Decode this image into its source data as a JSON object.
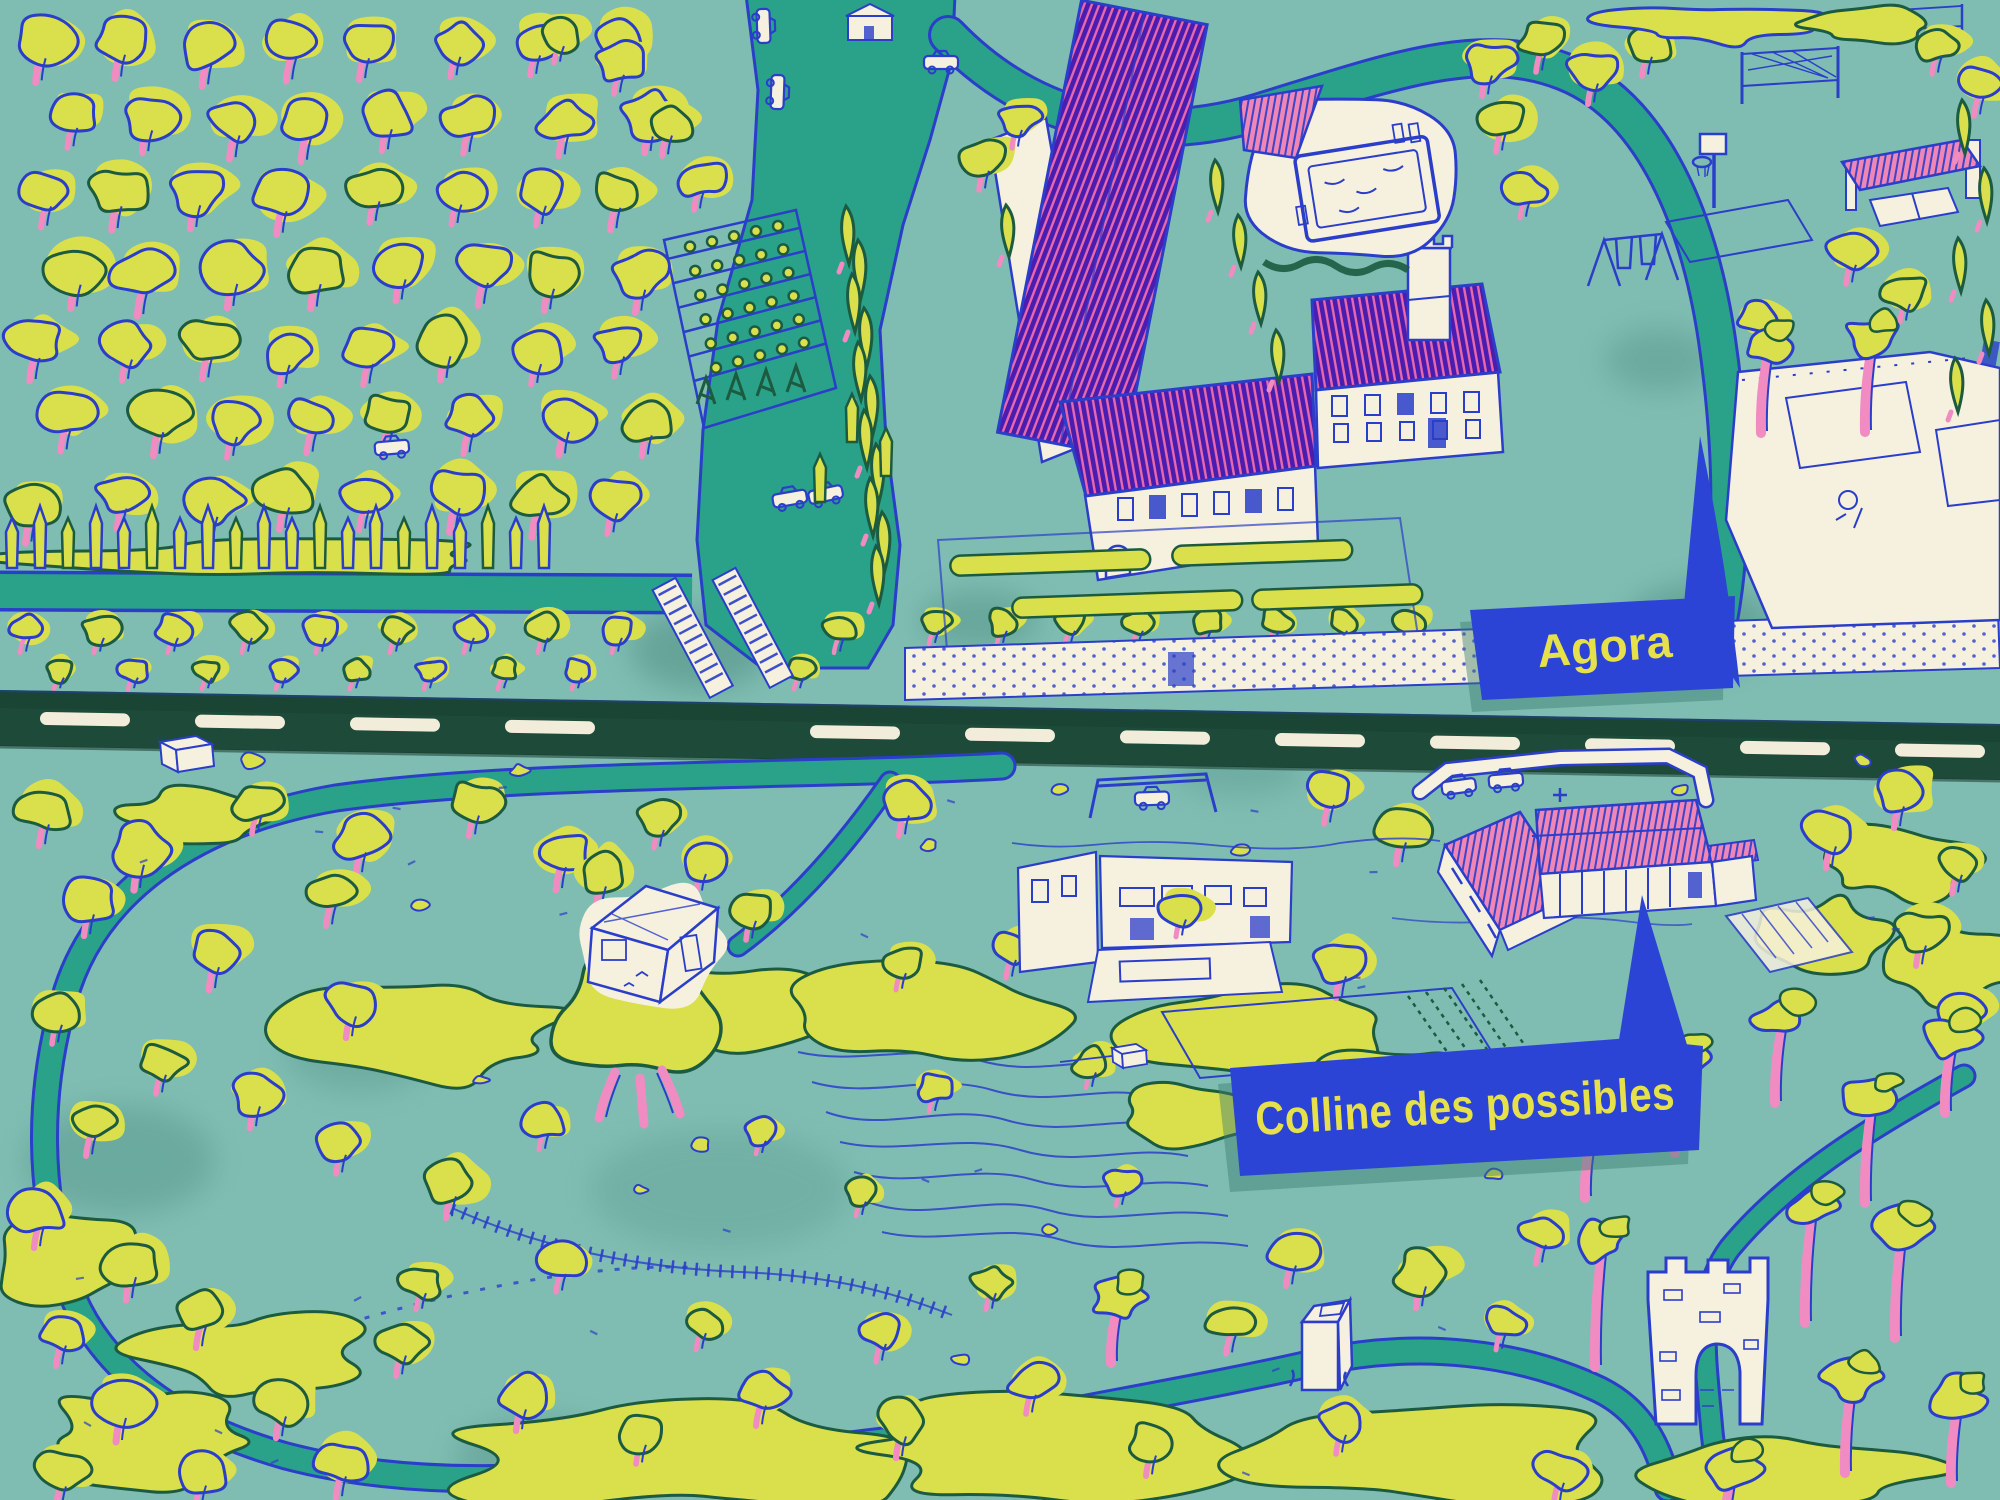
{
  "map": {
    "type": "illustrated-site-map",
    "labels": [
      {
        "id": "agora",
        "text": "Agora"
      },
      {
        "id": "colline-des-possibles",
        "text": "Colline des possibles"
      }
    ],
    "features": [
      "orchard",
      "vegetable-garden",
      "tree-lined-canal",
      "river",
      "stream-loop",
      "main-building",
      "agora-courtyard",
      "pool",
      "sports-ground",
      "playground",
      "road",
      "meadow",
      "marsh",
      "cabin",
      "modern-building",
      "farm-building",
      "greenhouse",
      "castle-ruins",
      "monolith",
      "water-tower",
      "parking"
    ],
    "palette": {
      "background": "#7fbdb2",
      "river": "#2aa189",
      "river_dark": "#3f7f72",
      "road": "#1d4a39",
      "road_dash": "#f2edda",
      "tree_yellow": "#d9e04b",
      "ink_blue": "#2b3ec9",
      "ink_green": "#1c5b40",
      "trunk_pink": "#f08cc2",
      "cream": "#f6f0df",
      "roof_purple": "#4a1caf",
      "roof_pink_stripe": "#e868ab",
      "farm_roof_pink": "#ef86b6",
      "banner_blue": "#2b44d6",
      "label_yellow": "#e6e04b",
      "shadow_teal": "#3f7f72"
    }
  }
}
